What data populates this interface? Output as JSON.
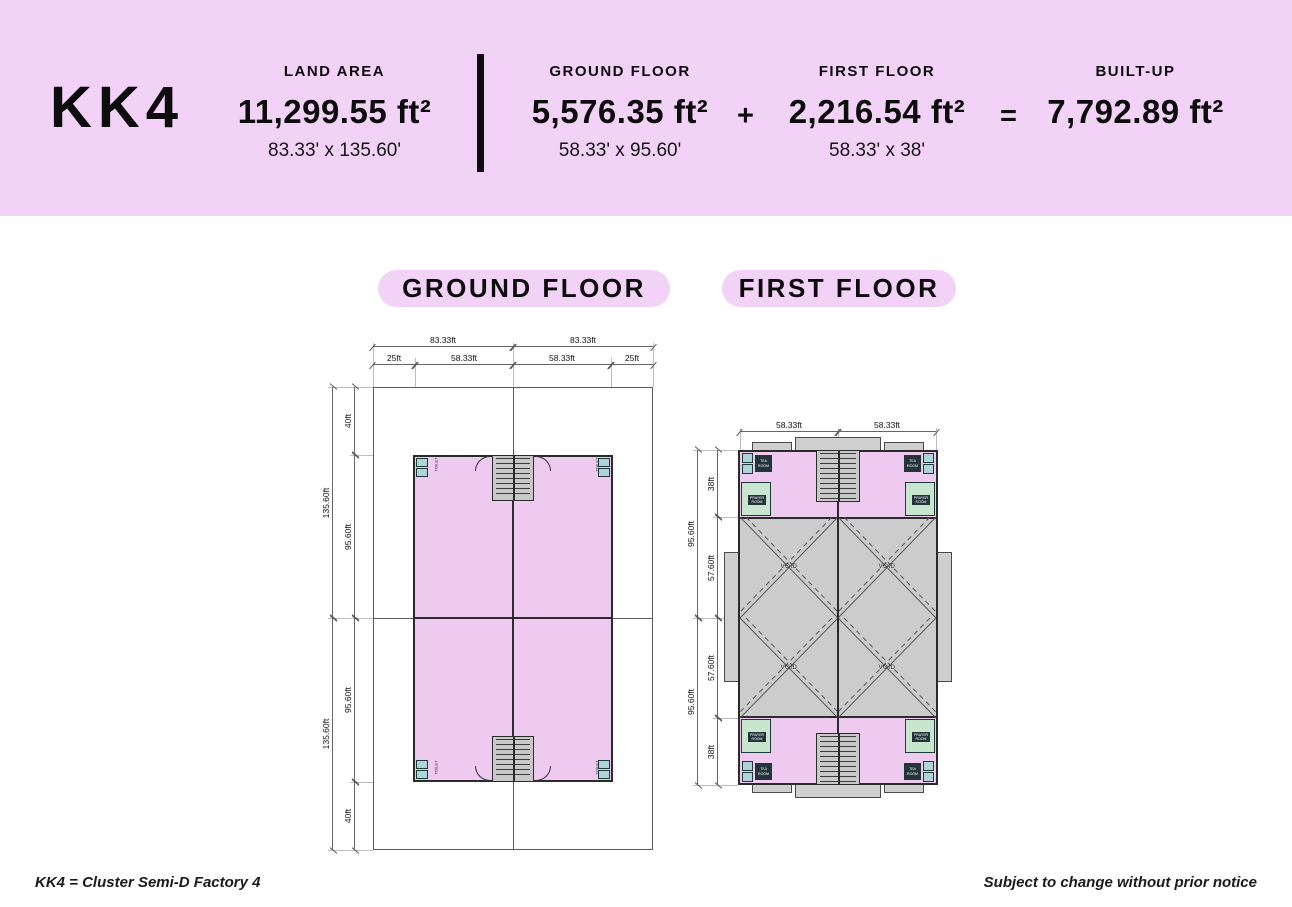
{
  "header": {
    "model": "KK4",
    "columns": {
      "land": {
        "label": "LAND AREA",
        "value": "11,299.55 ft²",
        "dims": "83.33' x 135.60'"
      },
      "ground": {
        "label": "GROUND FLOOR",
        "value": "5,576.35 ft²",
        "dims": "58.33' x 95.60'"
      },
      "first": {
        "label": "FIRST FLOOR",
        "value": "2,216.54 ft²",
        "dims": "58.33' x 38'"
      },
      "builtup": {
        "label": "BUILT-UP",
        "value": "7,792.89 ft²"
      }
    },
    "plus_sign": "+",
    "equals_sign": "="
  },
  "plans": {
    "ground": {
      "title": "GROUND FLOOR",
      "dims": {
        "top_overall": [
          "83.33ft",
          "83.33ft"
        ],
        "top_inner": [
          "25ft",
          "58.33ft",
          "58.33ft",
          "25ft"
        ],
        "left_overall": [
          "135.60ft",
          "135.60ft"
        ],
        "left_inner": [
          "40ft",
          "95.60ft",
          "95.60ft",
          "40ft"
        ]
      },
      "labels": {
        "toilet": "TOILET"
      }
    },
    "first": {
      "title": "FIRST FLOOR",
      "dims": {
        "top": [
          "58.33ft",
          "58.33ft"
        ],
        "left_overall": [
          "95.60ft",
          "95.60ft"
        ],
        "left_inner": [
          "38ft",
          "57.60ft",
          "57.60ft",
          "38ft"
        ]
      },
      "labels": {
        "void": "VOID",
        "tea_room": "TEA ROOM",
        "prayer_room": "PRAYER ROOM",
        "toilet": "TOILET"
      }
    }
  },
  "footer": {
    "legend": "KK4 = Cluster Semi-D Factory 4",
    "disclaimer": "Subject to change without prior notice"
  },
  "colors": {
    "band_pink": "#f3d2f7",
    "plan_pink": "#eecaf0",
    "void_gray": "#cccccc",
    "room_green": "#c7e6cd",
    "stall_teal": "#aed4d6"
  }
}
